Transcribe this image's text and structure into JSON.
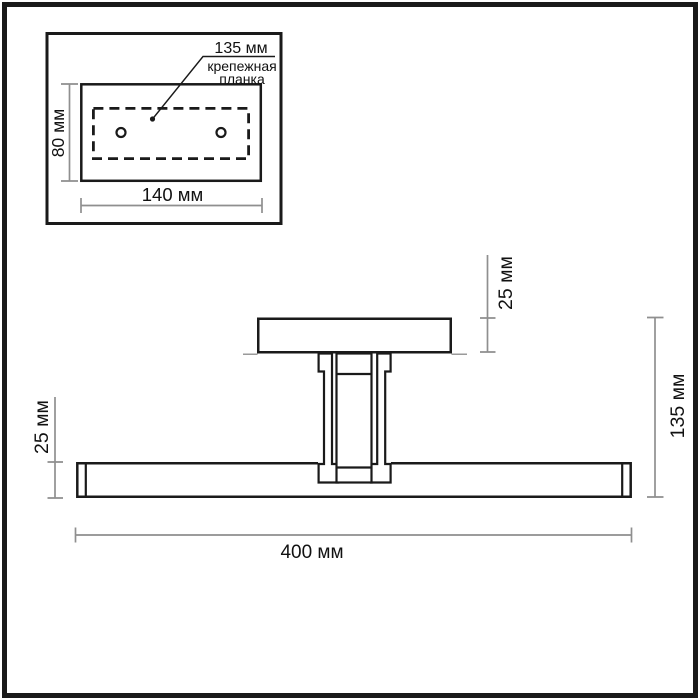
{
  "inset": {
    "plate_width_label": "135 мм",
    "caption_line1": "крепежная",
    "caption_line2": "планка",
    "height_label": "80 мм",
    "width_label": "140 мм"
  },
  "main": {
    "canopy_height_label": "25 мм",
    "bar_height_label": "25 мм",
    "overall_height_label": "135 мм",
    "overall_width_label": "400 мм"
  },
  "colors": {
    "object_line": "#1a1a1a",
    "dimension_line": "#8f8f8f",
    "text": "#111111",
    "background": "#ffffff"
  }
}
